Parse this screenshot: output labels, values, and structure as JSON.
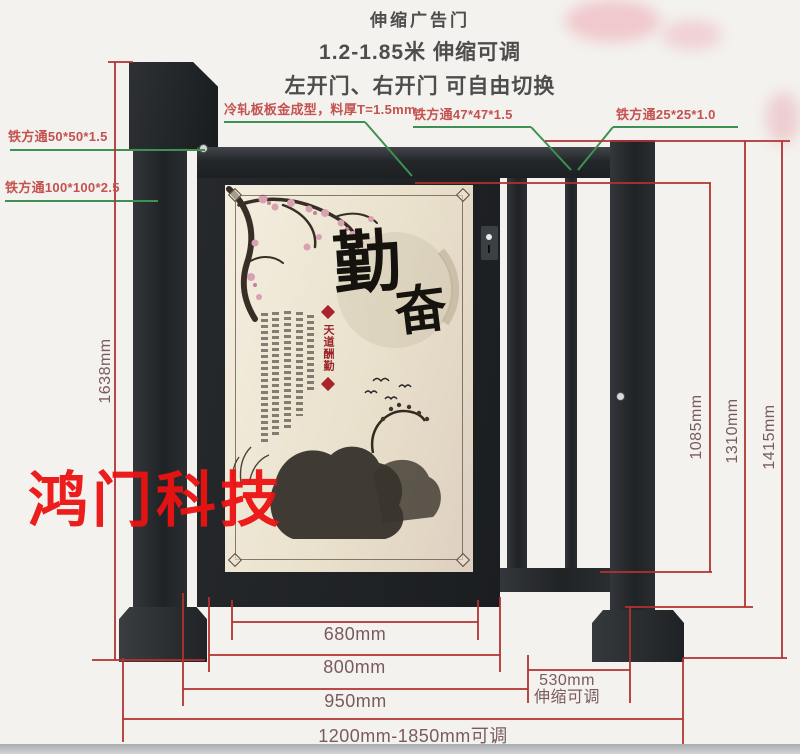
{
  "header": {
    "title": "伸缩广告门",
    "line2": "1.2-1.85米 伸缩可调",
    "line3": "左开门、右开门 可自由切换"
  },
  "watermark": {
    "text": "鸿门科技"
  },
  "callouts": {
    "square_tube_50": "铁方通50*50*1.5",
    "square_tube_100": "铁方通100*100*2.5",
    "cold_rolled_panel": "冷轧板板金成型，料厚T=1.5mm",
    "square_tube_47": "铁方通47*47*1.5",
    "square_tube_25": "铁方通25*25*1.0"
  },
  "dimensions": {
    "total_height": "1638mm",
    "inner_height": "1085mm",
    "mid_height": "1310mm",
    "pillar_height": "1415mm",
    "poster_width": "680mm",
    "door_width": "800mm",
    "frame_width": "950mm",
    "tele_width": "530mm",
    "tele_note": "伸缩可调",
    "total_width": "1200mm-1850mm可调"
  },
  "poster": {
    "calligraphy_char1": "勤",
    "calligraphy_char2": "奋",
    "banner_text": "天道酬勤"
  },
  "colors": {
    "dimension_line": "#b23230",
    "leader_line": "#3e9152",
    "callout_text": "#c4524e",
    "dimension_text": "#7a5b5b",
    "watermark": "#ec1212",
    "steel": "#232628",
    "poster_bg": "#ece4d0"
  }
}
